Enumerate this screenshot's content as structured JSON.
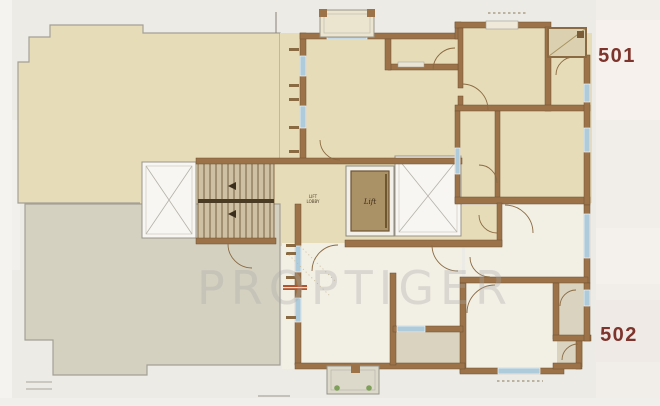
{
  "floor_plan": {
    "labels": {
      "unit_top": "501",
      "unit_bottom": "502",
      "lift": "Lift",
      "lobby_line1": "LIFT",
      "lobby_line2": "LOBBY"
    },
    "watermark": "PROPTIGER",
    "colors": {
      "paper": "#ecebe6",
      "unit_501_floor": "#e7dcb8",
      "unit_502_floor": "#f2efe4",
      "terrace_502": "#d5d1c1",
      "service_room": "#d9d3c0",
      "wall": "#9c7349",
      "window": "#aecbdb",
      "unit_label": "#7d342c",
      "stair_fill": "#cec0a2",
      "lift_cab": "#ab9166",
      "plant": "#7fa05a",
      "threshold_red": "#b5542c",
      "watermark_color": "#a6a6a6"
    }
  }
}
